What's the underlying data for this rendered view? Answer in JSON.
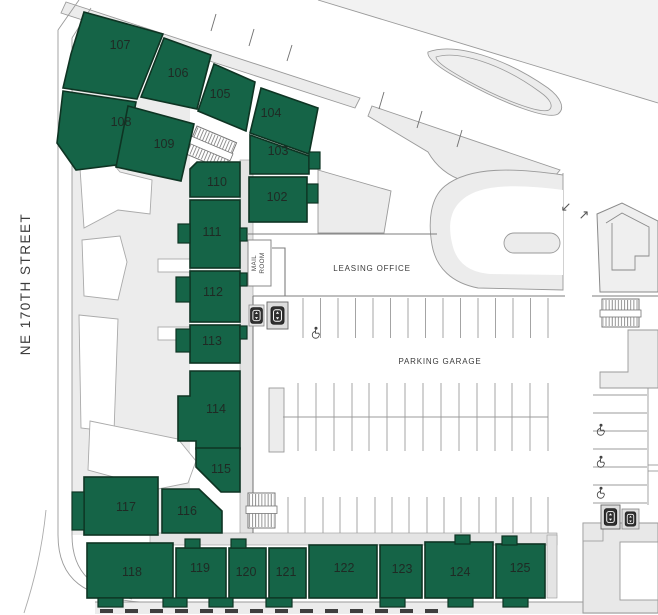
{
  "map": {
    "street_label": "NE 170TH STREET",
    "leasing_office_label": "LEASING OFFICE",
    "parking_garage_label": "PARKING GARAGE",
    "mail_room_line1": "MAIL",
    "mail_room_line2": "ROOM",
    "entry_arrow": "↙",
    "exit_arrow": "↗"
  },
  "units": [
    {
      "label": "107"
    },
    {
      "label": "106"
    },
    {
      "label": "105"
    },
    {
      "label": "104"
    },
    {
      "label": "108"
    },
    {
      "label": "109"
    },
    {
      "label": "103"
    },
    {
      "label": "102"
    },
    {
      "label": "110"
    },
    {
      "label": "111"
    },
    {
      "label": "112"
    },
    {
      "label": "113"
    },
    {
      "label": "114"
    },
    {
      "label": "115"
    },
    {
      "label": "116"
    },
    {
      "label": "117"
    },
    {
      "label": "118"
    },
    {
      "label": "119"
    },
    {
      "label": "120"
    },
    {
      "label": "121"
    },
    {
      "label": "122"
    },
    {
      "label": "123"
    },
    {
      "label": "124"
    },
    {
      "label": "125"
    }
  ],
  "icons": {
    "elevator": "elevator-up-down-box",
    "accessible_parking": "wheelchair",
    "stairs": "hatched-stairwell"
  },
  "colors": {
    "unit_fill": "#156447",
    "unit_border": "#0e3423",
    "ground": "#eeeeee",
    "band": "#ececec",
    "corridor": "#e4e4e4",
    "platform": "#e8e8e8",
    "outline": "#9a9a9a",
    "wall": "#7d7d7d",
    "label": "#3a3a3a"
  }
}
